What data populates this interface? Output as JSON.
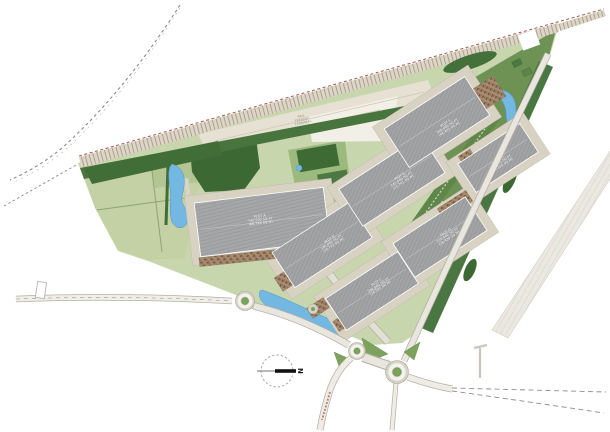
{
  "map": {
    "type": "site-masterplan",
    "north_arrow": {
      "label": "N"
    },
    "rail_terminal": {
      "line1": "RAIL",
      "line2": "FREIGHT",
      "line3": "TERMINAL"
    },
    "plots": [
      {
        "id": "A",
        "name": "PLOT A",
        "area_sqft": "740,000 SQ FT",
        "area_sqm": "(68,748 SQ M)"
      },
      {
        "id": "B",
        "name": "PLOT B",
        "area_sqft": "180,000 SQ FT",
        "area_sqm": "(16,723 SQ M)"
      },
      {
        "id": "C",
        "name": "PLOT C",
        "area_sqft": "200,000 SQ FT",
        "area_sqm": "(18,581 SQ M)"
      },
      {
        "id": "D",
        "name": "PLOT D",
        "area_sqft": "220,000 SQ FT",
        "area_sqm": "(20,439 SQ M)"
      },
      {
        "id": "E",
        "name": "PLOT E",
        "area_sqft": "245,000 SQ FT",
        "area_sqm": "(22,761 SQ M)"
      },
      {
        "id": "F",
        "name": "PLOT F",
        "area_sqft": "500,000 SQ FT",
        "area_sqm": "(46,452 SQ M)"
      },
      {
        "id": "G",
        "name": "PLOT G",
        "area_sqft": "165,000 SQ FT",
        "area_sqm": "(15,329 SQ M)"
      }
    ],
    "colors": {
      "site_green": "#c8d6ae",
      "field_green": "#c3d1a5",
      "woodland": "#3c6833",
      "hedge": "#48743d",
      "verge": "#6d9254",
      "rail_strip": "#ddd6c8",
      "terminal_beige": "#e7e1d3",
      "building_grey": "#a2a3a5",
      "apron": "#d8d2c3",
      "parking_brown": "#a98c6f",
      "water": "#73b8e2",
      "road": "#eceae2",
      "boundary_red": "#a3584c"
    }
  }
}
